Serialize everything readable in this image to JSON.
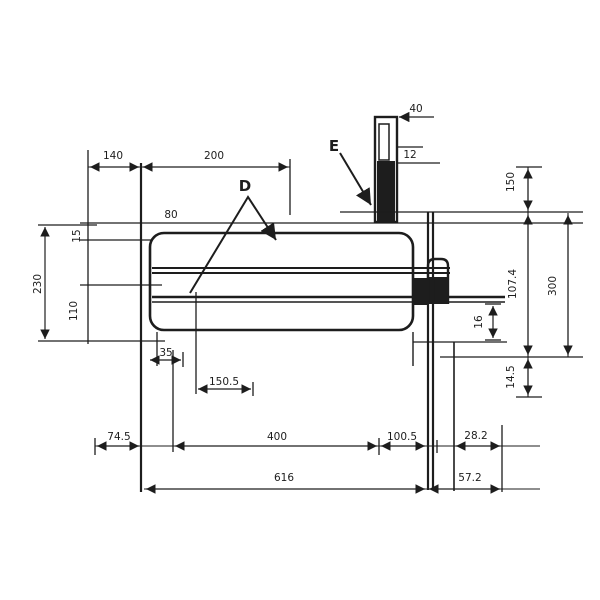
{
  "drawing": {
    "type": "engineering-dimension-drawing",
    "colors": {
      "line": "#1d1d1d",
      "background": "#ffffff"
    },
    "labels": {
      "top_width_left": "140",
      "top_width_right": "200",
      "tab_width": "40",
      "tab_slot": "12",
      "diameter_note": "80",
      "callout_d": "D",
      "callout_e": "E",
      "left_total": "230",
      "left_top": "15",
      "left_lower": "110",
      "right_upper": "150",
      "right_mid": "107.4",
      "right_outer": "300",
      "right_small": "16",
      "right_lower": "14.5",
      "notch_width": "35",
      "offset_left": "150.5",
      "bottom_a": "74.5",
      "bottom_b": "400",
      "bottom_c": "100.5",
      "bottom_d": "28.2",
      "bottom_total": "616",
      "bottom_right_offset": "57.2"
    }
  }
}
